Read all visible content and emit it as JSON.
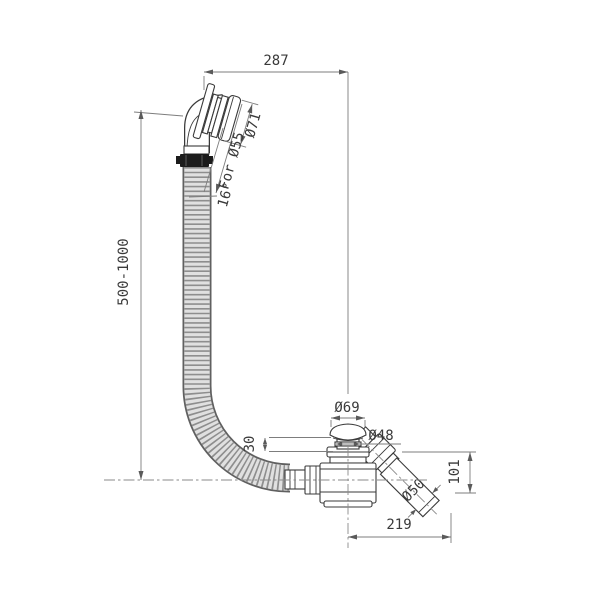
{
  "drawing": {
    "labels": {
      "overall_width": "287",
      "hose_length": "500-1000",
      "overflow_cap_diameter": "Ø71",
      "overflow_hole": "For Ø55",
      "overflow_angle": "16°",
      "waste_cap_diameter": "Ø69",
      "plug_lift_height": "30",
      "plug_diameter": "Ø48",
      "outlet_drop_height": "101",
      "outlet_pipe_diameter": "Ø50",
      "outlet_length": "219"
    },
    "colors": {
      "background": "#ffffff",
      "object_line": "#3a3a3a",
      "dimension_line": "#7d7d7d",
      "text": "#3a3a3a",
      "hose_fill": "#e0e0e0",
      "hose_rib": "#8e8e8e",
      "clamp_fill": "#1c1c1c"
    }
  }
}
